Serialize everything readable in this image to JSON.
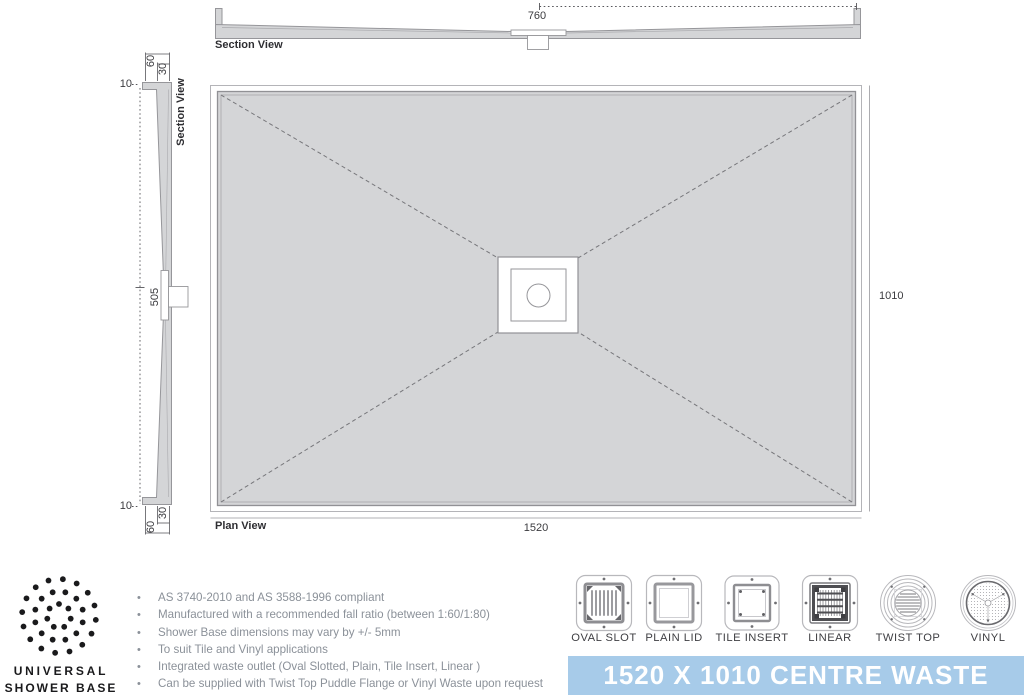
{
  "views": {
    "top_section": {
      "label": "Section View",
      "dim_center": "760"
    },
    "side_section": {
      "label": "Section View",
      "dim_edge_top": "10",
      "dim_lip_top": "60",
      "dim_inner_top": "30",
      "dim_center": "505",
      "dim_edge_bottom": "10",
      "dim_inner_bottom": "30",
      "dim_lip_bottom": "60"
    },
    "plan": {
      "label": "Plan View",
      "dim_length": "1520",
      "dim_width": "1010"
    }
  },
  "logo": {
    "name_line1": "UNIVERSAL",
    "name_line2": "SHOWER BASE"
  },
  "features": [
    "AS 3740-2010 and AS 3588-1996 compliant",
    "Manufactured with a recommended fall ratio (between 1:60/1:80)",
    "Shower Base dimensions may vary by +/- 5mm",
    "To suit Tile and Vinyl applications",
    "Integrated waste outlet (Oval Slotted, Plain, Tile Insert, Linear )",
    "Can be supplied with Twist Top Puddle Flange or Vinyl Waste upon request"
  ],
  "waste_options": [
    {
      "label": "OVAL SLOT"
    },
    {
      "label": "PLAIN LID"
    },
    {
      "label": "TILE INSERT"
    },
    {
      "label": "LINEAR"
    },
    {
      "label": "TWIST TOP"
    },
    {
      "label": "VINYL"
    }
  ],
  "banner": {
    "title": "1520 X 1010 CENTRE WASTE",
    "background": "#A7CBE9"
  },
  "colors": {
    "base_fill": "#D4D5D7",
    "base_outline": "#96969A",
    "dimension_text": "#3B3B3F",
    "feature_text": "#8B9199",
    "banner_blue": "#A7CBE9",
    "banner_text": "#FFFFFF",
    "logo_black": "#1A1A1C"
  }
}
